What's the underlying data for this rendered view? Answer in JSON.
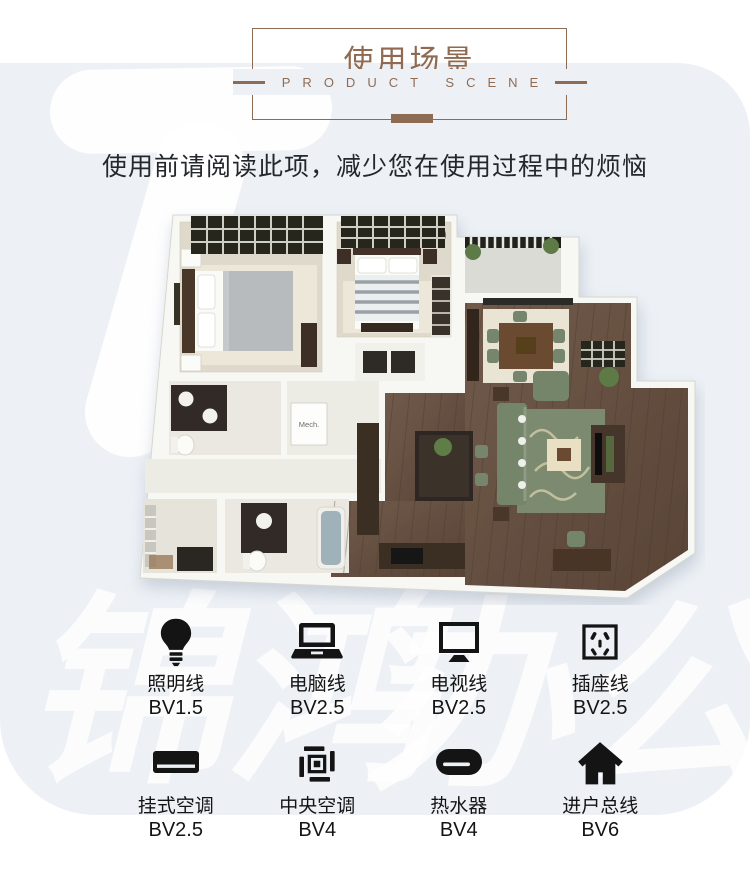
{
  "theme": {
    "panel_bg": "#edf1f6",
    "accent": "#8e6c54",
    "title_color": "#8f6a50",
    "label_color": "#141414"
  },
  "header": {
    "title": "使用场景",
    "subtitle": "PRODUCT SCENE"
  },
  "intro": {
    "text": "使用前请阅读此项，减少您在使用过程中的烦恼"
  },
  "watermark": {
    "left": "锦鸿",
    "right": "办公"
  },
  "floorplan": {
    "mech_label": "Mech."
  },
  "wires": {
    "rows": [
      {
        "items": [
          {
            "name": "照明线",
            "spec": "BV1.5",
            "icon": "bulb-icon"
          },
          {
            "name": "电脑线",
            "spec": "BV2.5",
            "icon": "laptop-icon"
          },
          {
            "name": "电视线",
            "spec": "BV2.5",
            "icon": "tv-icon"
          },
          {
            "name": "插座线",
            "spec": "BV2.5",
            "icon": "socket-icon"
          }
        ]
      },
      {
        "items": [
          {
            "name": "挂式空调",
            "spec": "BV2.5",
            "icon": "wall-ac-icon"
          },
          {
            "name": "中央空调",
            "spec": "BV4",
            "icon": "central-ac-icon"
          },
          {
            "name": "热水器",
            "spec": "BV4",
            "icon": "water-heater-icon"
          },
          {
            "name": "进户总线",
            "spec": "BV6",
            "icon": "house-icon"
          }
        ]
      }
    ]
  }
}
